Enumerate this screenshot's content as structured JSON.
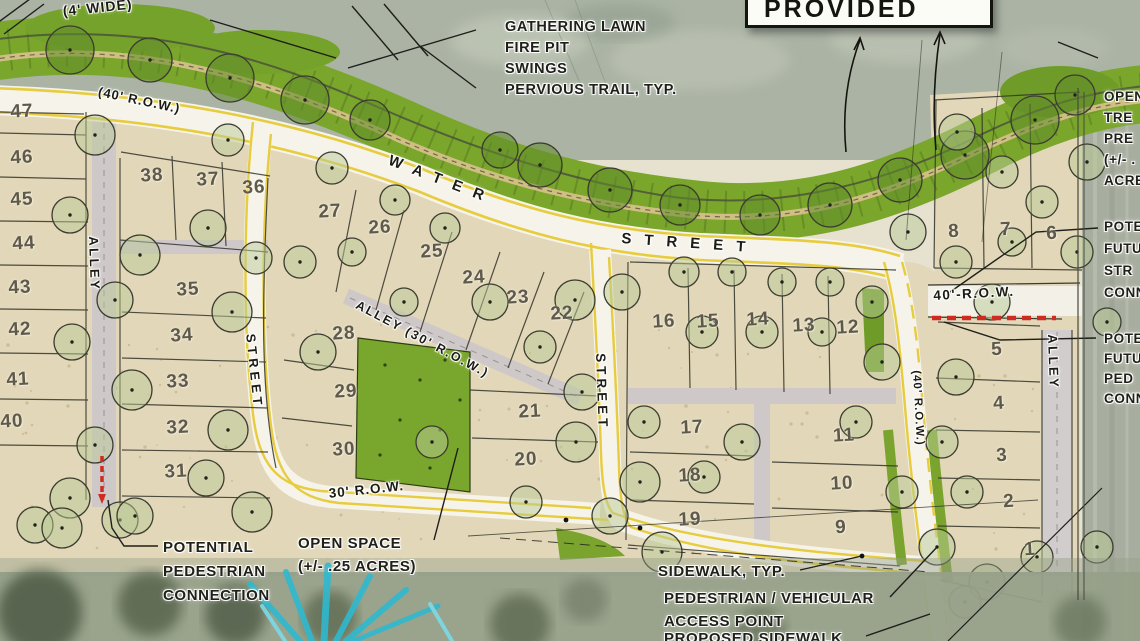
{
  "provided_box": {
    "label": "PROVIDED"
  },
  "colors": {
    "buffer_green": "#7aa62c",
    "open_space_green": "#79a62c",
    "lot_tan": "#e2d7b8",
    "road_white": "#f6f4ea",
    "road_yellow": "#e6cc3e",
    "alley_gray": "#cfc8c9",
    "water_gray": "#aab3a4",
    "red_dash": "#cf2b20",
    "cyan_accent": "#35c2d4",
    "ink": "#23231c"
  },
  "street_labels": [
    {
      "id": "wide-4",
      "text": "(4' WIDE)",
      "x": 62,
      "y": 3,
      "rotate": -6,
      "size": 14,
      "ls": 1
    },
    {
      "id": "row-40-top",
      "text": "(40' R.O.W.)",
      "x": 100,
      "y": 84,
      "rotate": 12,
      "size": 13,
      "ls": 1
    },
    {
      "id": "water",
      "text": "WATER",
      "x": 392,
      "y": 152,
      "rotate": 21,
      "size": 15,
      "ls": 12
    },
    {
      "id": "street-water",
      "text": "STREET",
      "x": 622,
      "y": 230,
      "rotate": 4,
      "size": 15,
      "ls": 13
    },
    {
      "id": "alley-30-row",
      "text": "ALLEY (30' R.O.W.)",
      "x": 360,
      "y": 298,
      "rotate": 28,
      "size": 12.5,
      "ls": 2
    },
    {
      "id": "alley-left",
      "text": "ALLEY",
      "x": 101,
      "y": 236,
      "rotate": 88,
      "size": 13,
      "ls": 2.5
    },
    {
      "id": "street-left",
      "text": "STREET",
      "x": 258,
      "y": 333,
      "rotate": 84,
      "size": 13,
      "ls": 4
    },
    {
      "id": "street-mid",
      "text": "STREET",
      "x": 608,
      "y": 353,
      "rotate": 88,
      "size": 13.5,
      "ls": 4
    },
    {
      "id": "row-30-bottom",
      "text": "30' R.O.W.",
      "x": 328,
      "y": 486,
      "rotate": -6,
      "size": 13.5,
      "ls": 1
    },
    {
      "id": "row-40-right-v",
      "text": "(40' R.O.W.)",
      "x": 922,
      "y": 370,
      "rotate": 87,
      "size": 11.5,
      "ls": 1
    },
    {
      "id": "row-40-right-h",
      "text": "40'-R.O.W.",
      "x": 933,
      "y": 288,
      "rotate": -3,
      "size": 13.5,
      "ls": 1.5
    },
    {
      "id": "alley-right",
      "text": "ALLEY",
      "x": 1060,
      "y": 334,
      "rotate": 88,
      "size": 13,
      "ls": 2.5
    }
  ],
  "lots": [
    {
      "n": "47",
      "x": 22,
      "y": 112
    },
    {
      "n": "46",
      "x": 22,
      "y": 158
    },
    {
      "n": "45",
      "x": 22,
      "y": 200
    },
    {
      "n": "44",
      "x": 24,
      "y": 244
    },
    {
      "n": "43",
      "x": 20,
      "y": 288
    },
    {
      "n": "42",
      "x": 20,
      "y": 330
    },
    {
      "n": "41",
      "x": 18,
      "y": 380
    },
    {
      "n": "40",
      "x": 12,
      "y": 422
    },
    {
      "n": "38",
      "x": 152,
      "y": 176
    },
    {
      "n": "37",
      "x": 208,
      "y": 180
    },
    {
      "n": "36",
      "x": 254,
      "y": 188
    },
    {
      "n": "35",
      "x": 188,
      "y": 290
    },
    {
      "n": "34",
      "x": 182,
      "y": 336
    },
    {
      "n": "33",
      "x": 178,
      "y": 382
    },
    {
      "n": "32",
      "x": 178,
      "y": 428
    },
    {
      "n": "31",
      "x": 176,
      "y": 472
    },
    {
      "n": "30",
      "x": 344,
      "y": 450
    },
    {
      "n": "29",
      "x": 346,
      "y": 392
    },
    {
      "n": "28",
      "x": 344,
      "y": 334
    },
    {
      "n": "27",
      "x": 330,
      "y": 212
    },
    {
      "n": "26",
      "x": 380,
      "y": 228
    },
    {
      "n": "25",
      "x": 432,
      "y": 252
    },
    {
      "n": "24",
      "x": 474,
      "y": 278
    },
    {
      "n": "23",
      "x": 518,
      "y": 298
    },
    {
      "n": "22",
      "x": 562,
      "y": 314
    },
    {
      "n": "21",
      "x": 530,
      "y": 412
    },
    {
      "n": "20",
      "x": 526,
      "y": 460
    },
    {
      "n": "19",
      "x": 690,
      "y": 520
    },
    {
      "n": "18",
      "x": 690,
      "y": 476
    },
    {
      "n": "17",
      "x": 692,
      "y": 428
    },
    {
      "n": "16",
      "x": 664,
      "y": 322
    },
    {
      "n": "15",
      "x": 708,
      "y": 322
    },
    {
      "n": "14",
      "x": 758,
      "y": 320
    },
    {
      "n": "13",
      "x": 804,
      "y": 326
    },
    {
      "n": "12",
      "x": 848,
      "y": 328
    },
    {
      "n": "11",
      "x": 844,
      "y": 436
    },
    {
      "n": "10",
      "x": 842,
      "y": 484
    },
    {
      "n": "9",
      "x": 841,
      "y": 528
    },
    {
      "n": "8",
      "x": 954,
      "y": 232
    },
    {
      "n": "7",
      "x": 1006,
      "y": 230
    },
    {
      "n": "6",
      "x": 1052,
      "y": 234
    },
    {
      "n": "5",
      "x": 997,
      "y": 350
    },
    {
      "n": "4",
      "x": 999,
      "y": 404
    },
    {
      "n": "3",
      "x": 1002,
      "y": 456
    },
    {
      "n": "2",
      "x": 1009,
      "y": 502
    },
    {
      "n": "1",
      "x": 1030,
      "y": 550
    }
  ],
  "annotations": [
    {
      "id": "gathering-lawn",
      "x": 505,
      "y": 17,
      "size": 14.5,
      "lh": 21,
      "lines": [
        "GATHERING LAWN",
        "FIRE PIT",
        "SWINGS"
      ]
    },
    {
      "id": "pervious-trail",
      "x": 505,
      "y": 80,
      "size": 14.5,
      "lh": 21,
      "lines": [
        "PERVIOUS TRAIL, TYP."
      ]
    },
    {
      "id": "open-tree-right",
      "x": 1104,
      "y": 86,
      "size": 13.5,
      "lh": 21,
      "lines": [
        "OPEN",
        "TRE",
        "PRE",
        "(+/- .",
        "ACRE"
      ]
    },
    {
      "id": "future-street-right",
      "x": 1104,
      "y": 216,
      "size": 13.5,
      "lh": 22,
      "lines": [
        "POTE",
        "FUTU",
        "STR",
        "CONN"
      ]
    },
    {
      "id": "future-ped-right",
      "x": 1104,
      "y": 329,
      "size": 13.5,
      "lh": 20,
      "lines": [
        "POTE",
        "FUTU",
        "PED",
        "CONN"
      ]
    },
    {
      "id": "potential-ped",
      "x": 163,
      "y": 536,
      "size": 15,
      "lh": 24,
      "lines": [
        "POTENTIAL",
        "PEDESTRIAN",
        "CONNECTION"
      ]
    },
    {
      "id": "open-space",
      "x": 298,
      "y": 532,
      "size": 15,
      "lh": 23,
      "lines": [
        "OPEN SPACE",
        "(+/- .25 ACRES)"
      ]
    },
    {
      "id": "sidewalk-typ",
      "x": 658,
      "y": 561,
      "size": 15,
      "lh": 22,
      "lines": [
        "SIDEWALK, TYP."
      ]
    },
    {
      "id": "ped-vehicular",
      "x": 664,
      "y": 587,
      "size": 15,
      "lh": 23,
      "lines": [
        "PEDESTRIAN / VEHICULAR",
        "ACCESS POINT"
      ]
    },
    {
      "id": "proposed-sidewalk",
      "x": 664,
      "y": 628,
      "size": 15,
      "lh": 22,
      "lines": [
        "PROPOSED SIDEWALK"
      ]
    }
  ]
}
